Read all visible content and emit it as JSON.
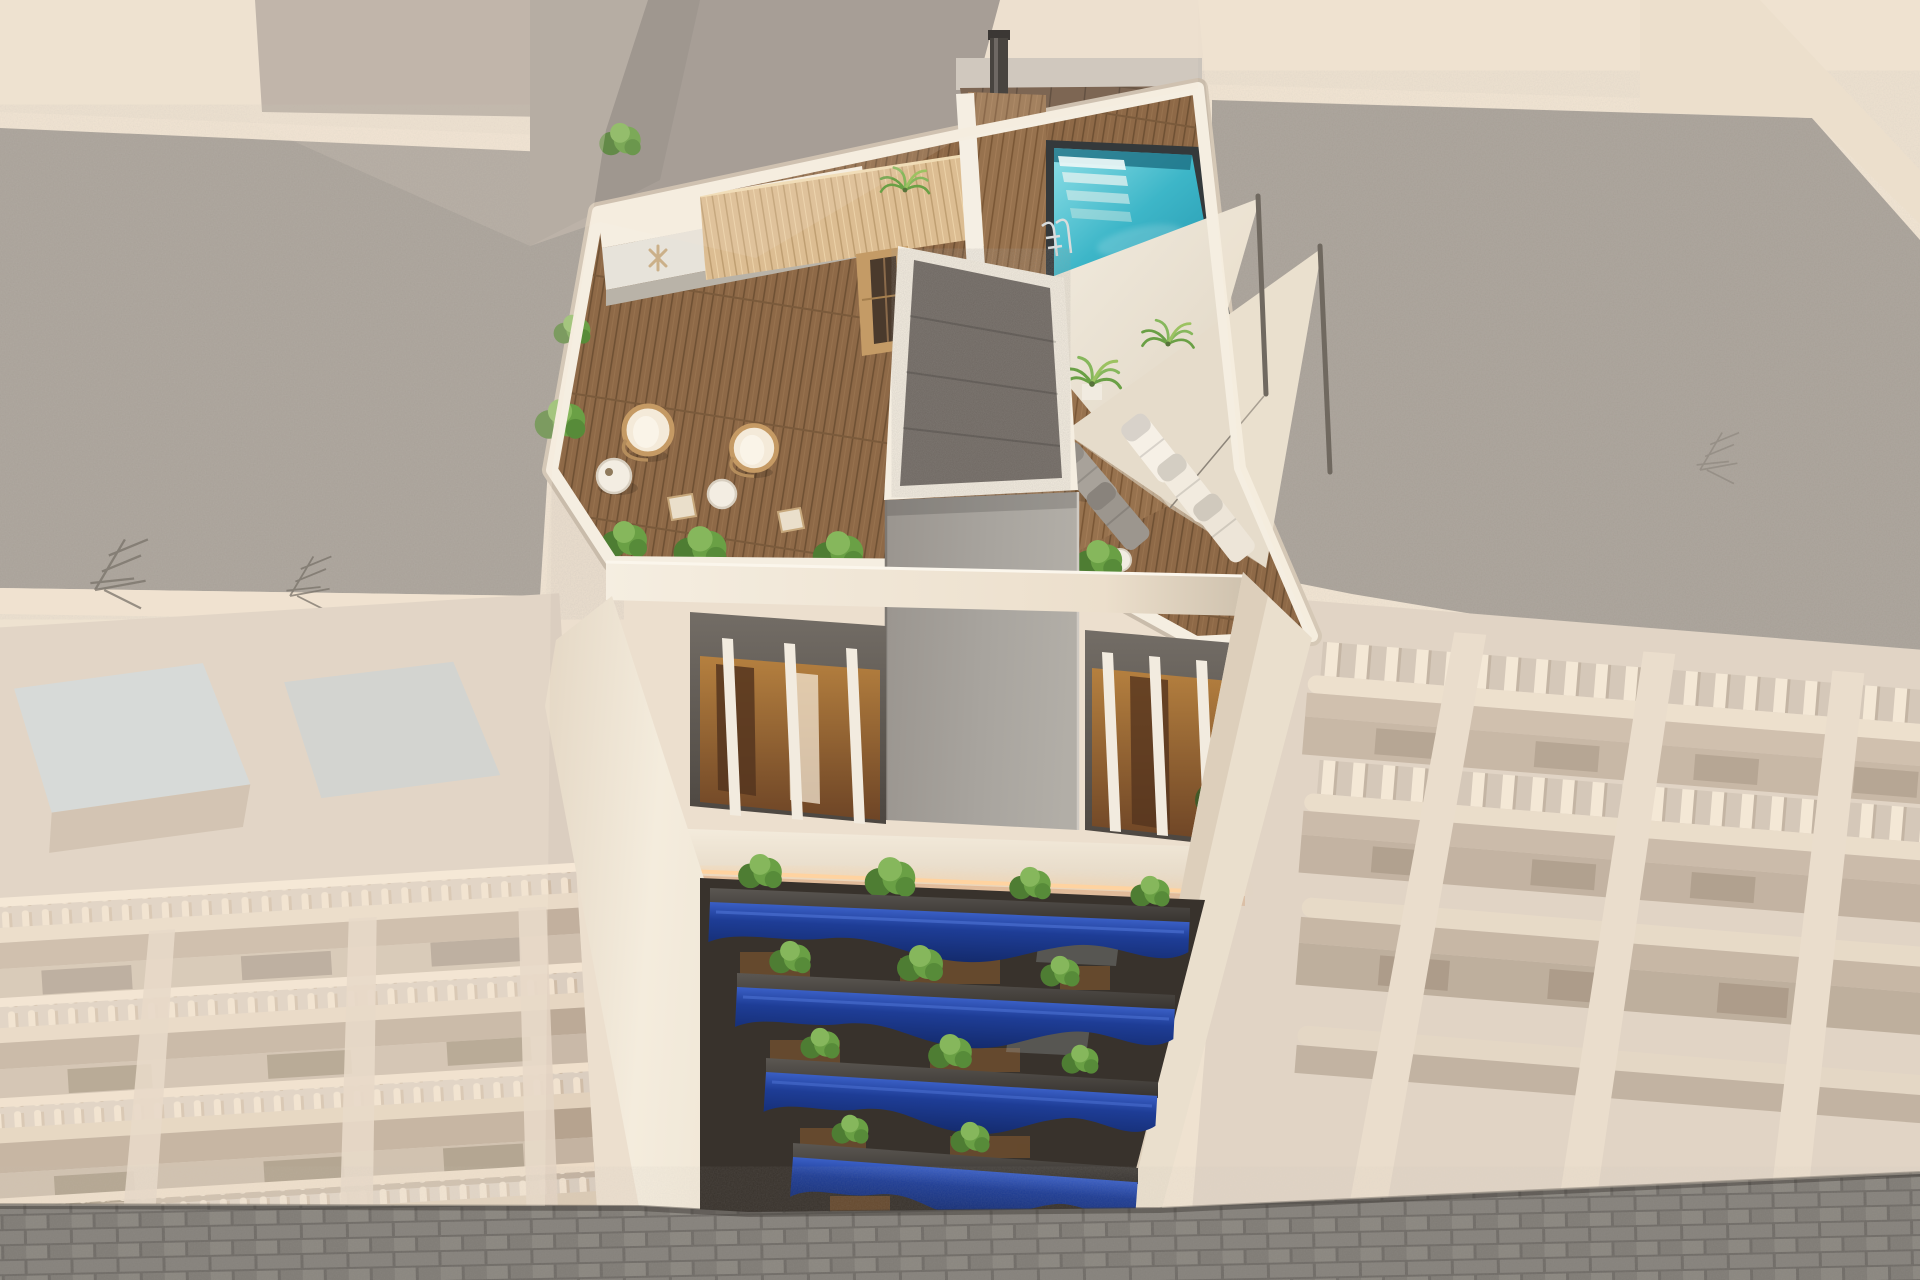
{
  "scene": {
    "type": "3d-architectural-render",
    "view": "aerial-birds-eye",
    "subject": "modern-apartment-building-with-rooftop-pool-terrace",
    "lighting": "warm-evening-sun",
    "focus": "center building rendered in vivid color, neighbouring buildings washed out"
  },
  "featured_building": {
    "balcony_levels": 4,
    "balcony_style": "royal-blue-wave-fascia-with-dark-granite-shelf-and-plants",
    "attic_level": "white-vertical-slat-pergola-terraces",
    "roof_amenities": [
      "swimming-pool",
      "pool-ladder",
      "underwater-steps",
      "wood-deck",
      "pergola",
      "sauna-cabin",
      "outdoor-kitchen-with-grill",
      "shade-sails",
      "sun-loungers",
      "hanging-egg-chairs",
      "side-tables",
      "planters",
      "elevator-shaft",
      "led-cove-light",
      "outdoor-shower-pole"
    ],
    "shade_sails": 2,
    "white_loungers": 3,
    "gray_loungers": 2,
    "egg_chairs": 2,
    "slats_left_bay": 3,
    "slats_right_bay": 4
  },
  "neighbourhood": {
    "left_building": "classic-facade-with-balustrade-balconies",
    "right_building": "modern-facade-with-vertical-slat-railings",
    "rooftops": "gray-gravel-with-beige-parapets-and-tv-antennas",
    "street": "gray-brick-paved-street"
  },
  "palette": {
    "bg_beige": "#ecdfce",
    "alley_beige": "#e4d5c2",
    "bg_gray_block": "#a29890",
    "gravel": "#8b8580",
    "gravel_dark": "#6e6761",
    "parapet_light": "#f2e4d2",
    "parapet_front": "#efe0cd",
    "neighbor_wall": "#dbcec0",
    "neighbor_wall_r": "#d9ccbe",
    "neighbor_shadow": "#c2b09e",
    "neighbor_recess": "#b8a695",
    "window_dark": "#a08e7c",
    "skylight_glass": "#ccd4d8",
    "white_wall": "#f5eee1",
    "cream_wall": "#efe5d4",
    "gray_wall": "#9b948d",
    "shaft_body": "#a5a19b",
    "tile_brown": "#6b5340",
    "cap_band": "#cbc4bb",
    "wood_deck": "#8e6947",
    "pergola_wood": "#dcbd92",
    "sauna_wood": "#c49b66",
    "pool_border": "#34393b",
    "pool_deep": "#1f8fa8",
    "pool_light": "#8fe0e8",
    "curb_white": "#f5efe4",
    "slat_white": "#f2ebdf",
    "recess_dark": "#5f5954",
    "interior_warm": "#b5803f",
    "led_glow": "#ffd3a0",
    "balcony_blue": "#1c3a8e",
    "balcony_blue_light": "#3a5fc5",
    "balcony_blue_dark": "#142b6d",
    "granite": "#43403b",
    "plant_green": "#4e7d33",
    "plant_mid": "#6aa045",
    "plant_light": "#86b75c",
    "sail_fabric": "#eee7d9",
    "sail_fabric_2": "#e6dccb",
    "lounger_white": "#f6f0e6",
    "lounger_gray": "#a8a29a",
    "metal_dark": "#2e2c29",
    "street_paver": "#817d77",
    "street_joint": "#6f6b66",
    "backdrop_dark": "#38322c",
    "veil_warm": "#f6ead9"
  }
}
